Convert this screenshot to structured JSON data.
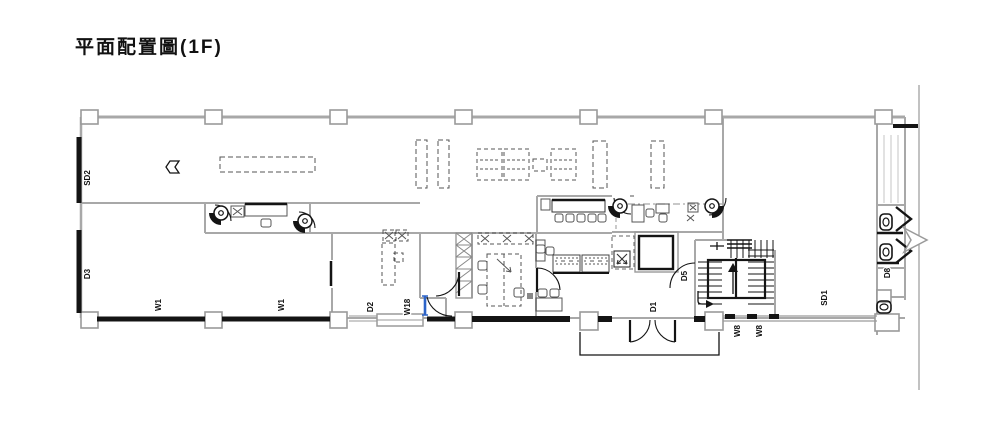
{
  "title": "平面配置圖(1F)",
  "plan": {
    "labels": {
      "sd2": "SD2",
      "d3": "D3",
      "w1_left": "W1",
      "w1_right": "W1",
      "d2": "D2",
      "w18": "W18",
      "d1": "D1",
      "d5": "D5",
      "w8_left": "W8",
      "w8_right": "W8",
      "sd1": "SD1",
      "d8": "D8"
    },
    "colors": {
      "wall_gray": "#a8a8a8",
      "line_black": "#141414",
      "door_blue": "#2c63c8"
    },
    "icons": [
      "door-tag-icon",
      "toilet-icon",
      "elevator-icon",
      "stair-up-arrow-icon",
      "entrance-chevron-icon",
      "nav-arrow-icon"
    ]
  }
}
